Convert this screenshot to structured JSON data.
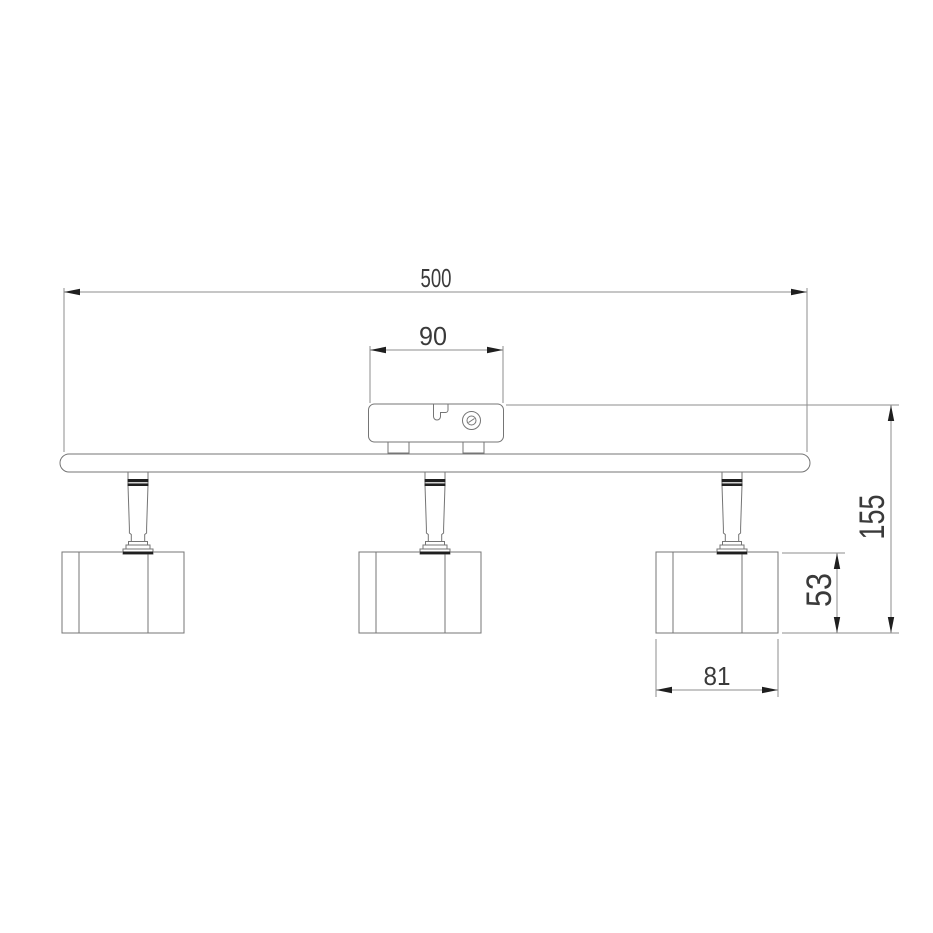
{
  "drawing": {
    "labels": {
      "overall_width": "500",
      "bracket_width": "90",
      "overall_height": "155",
      "head_height": "53",
      "head_width": "81"
    },
    "colors": {
      "background": "#ffffff",
      "outline": "#757575",
      "dimension_line": "#8e8e8e",
      "dark_accent": "#1f1f1f",
      "label_text": "#3a3a3a"
    }
  }
}
